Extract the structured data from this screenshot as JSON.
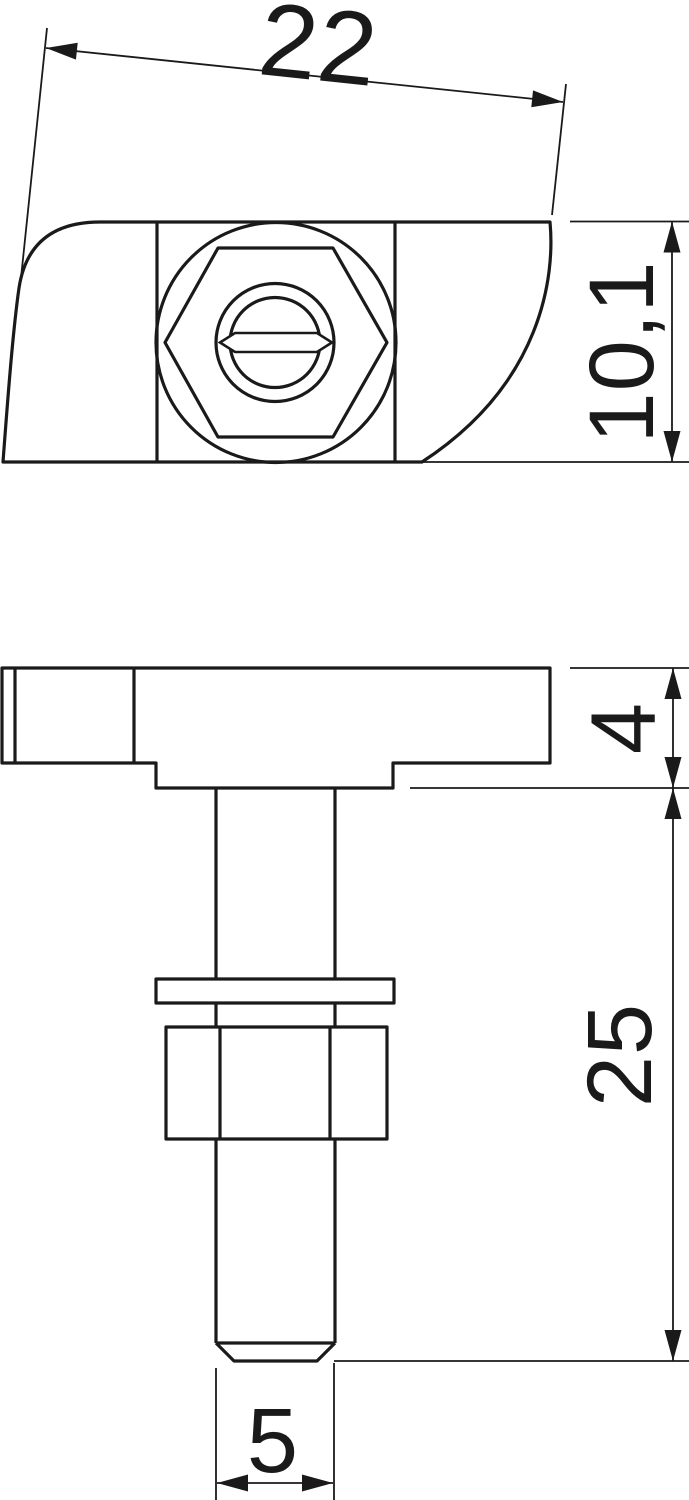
{
  "drawing": {
    "background": "#ffffff",
    "line_color": "#1a1a1a",
    "dimensions": {
      "plate_width": {
        "label": "22"
      },
      "plate_depth": {
        "label": "10,1"
      },
      "plate_thickness": {
        "label": "4"
      },
      "shaft_length": {
        "label": "25"
      },
      "tip_diameter": {
        "label": "5"
      }
    }
  }
}
